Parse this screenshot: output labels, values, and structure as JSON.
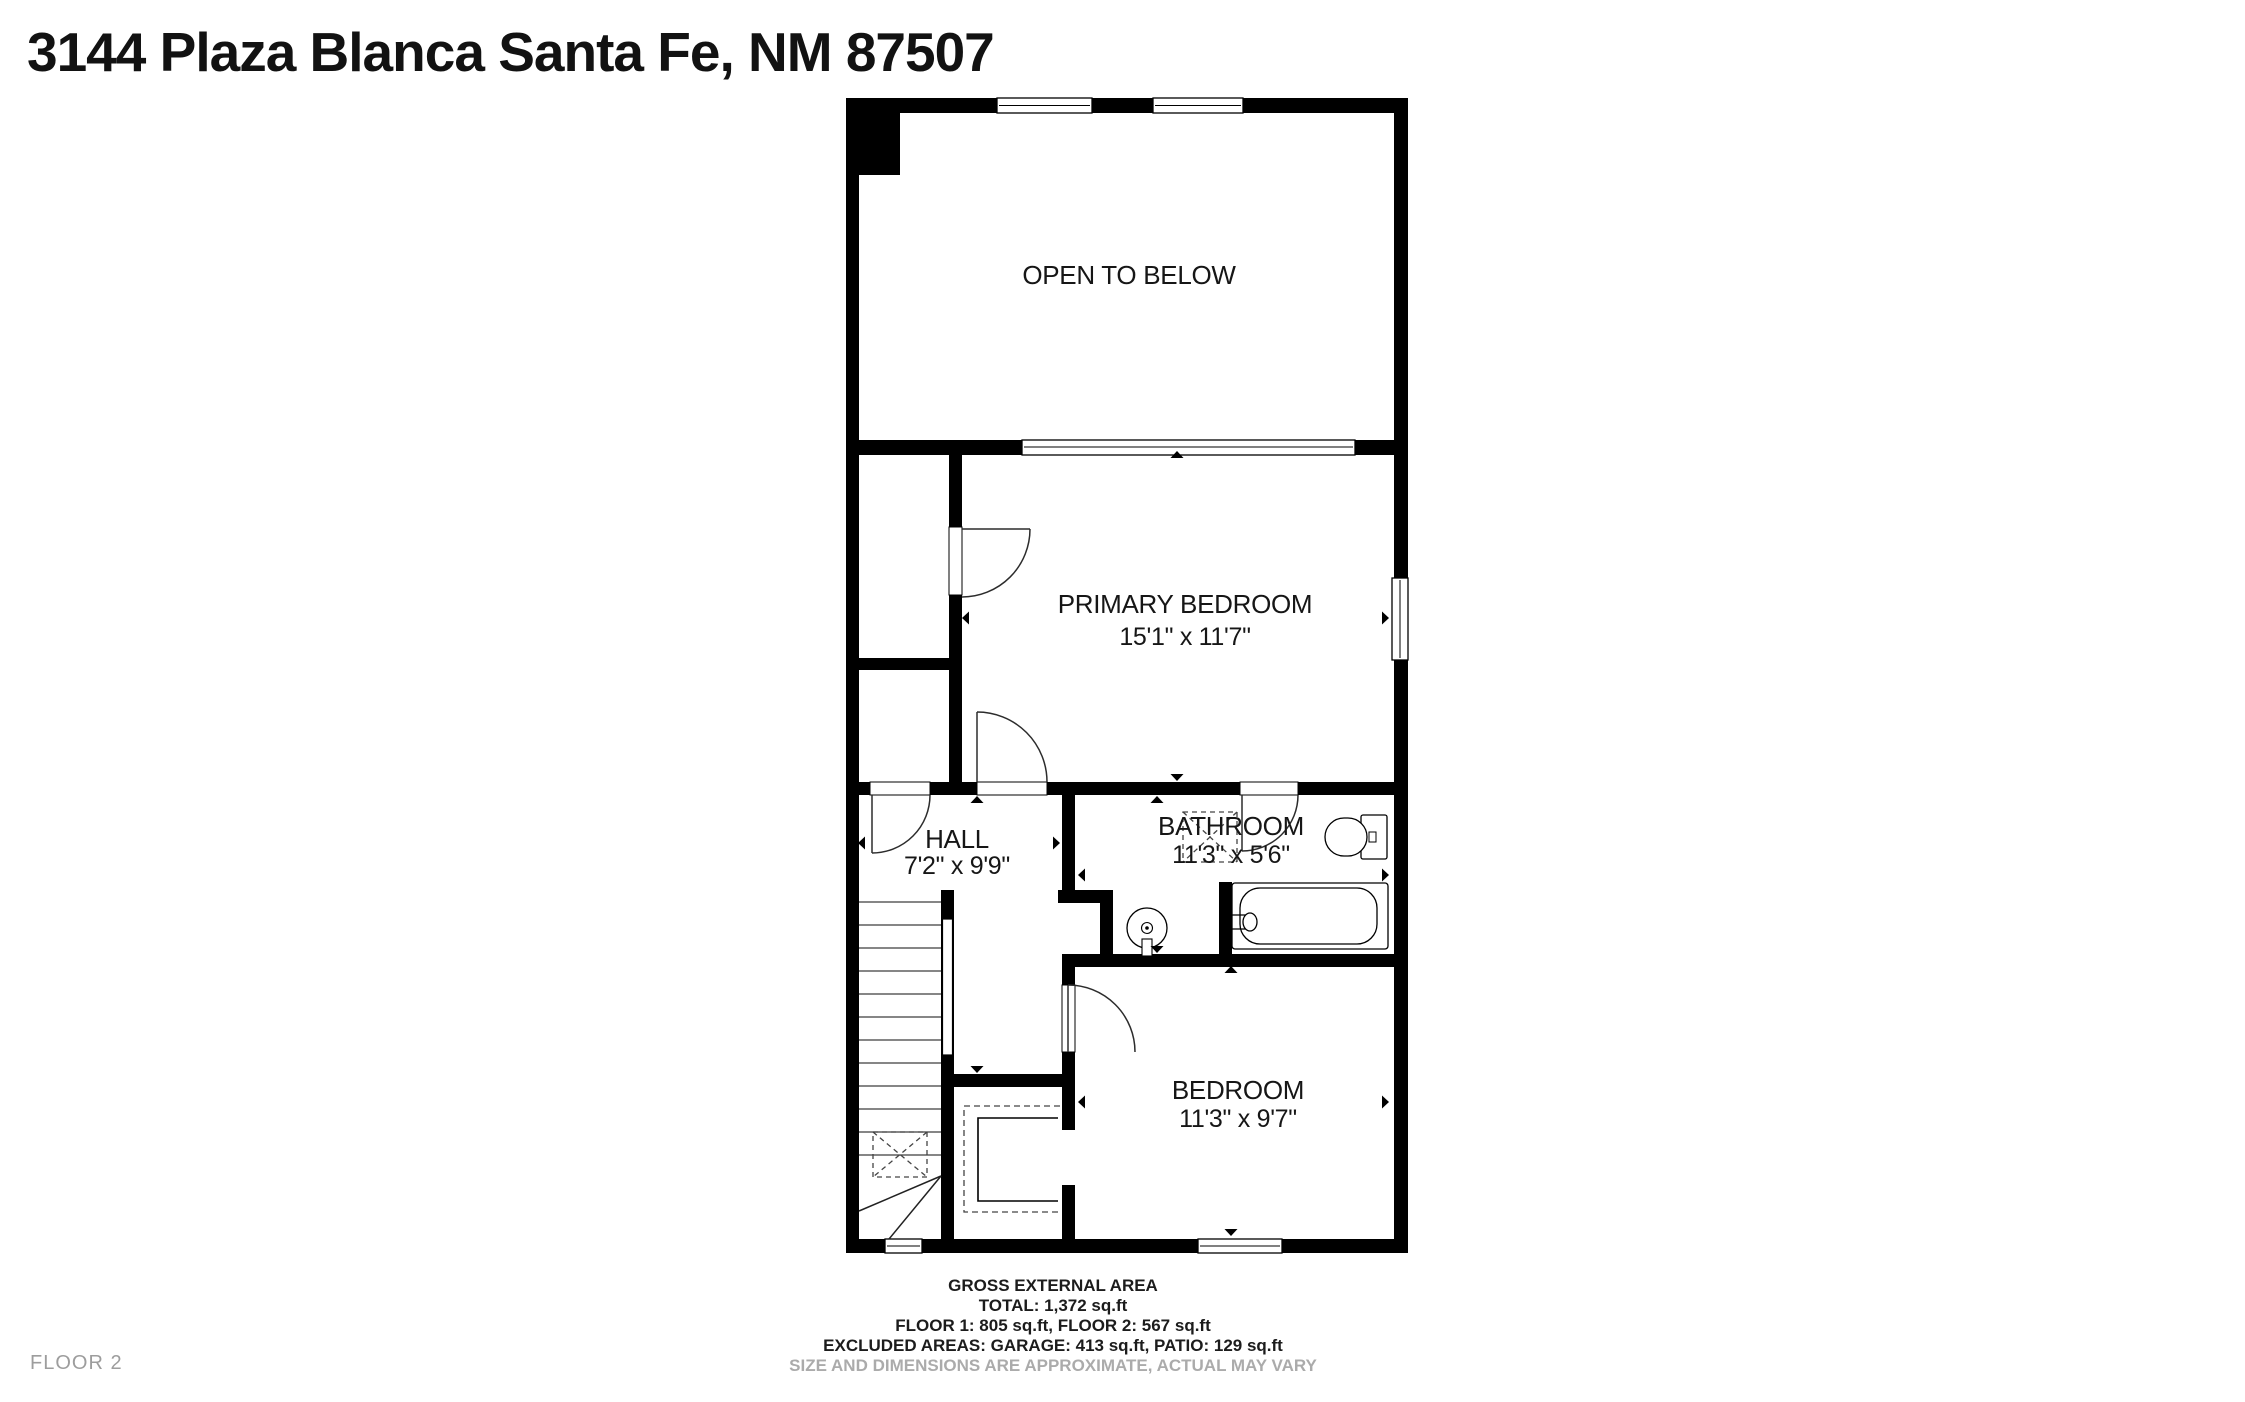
{
  "title": "3144 Plaza Blanca Santa Fe, NM 87507",
  "floor_label": "FLOOR 2",
  "rooms": {
    "open_to_below": {
      "name": "OPEN TO BELOW"
    },
    "primary_bedroom": {
      "name": "PRIMARY BEDROOM",
      "dimensions": "15'1\" x 11'7\""
    },
    "hall": {
      "name": "HALL",
      "dimensions": "7'2\" x 9'9\""
    },
    "bathroom": {
      "name": "BATHROOM",
      "dimensions": "11'3\" x 5'6\""
    },
    "bedroom": {
      "name": "BEDROOM",
      "dimensions": "11'3\" x 9'7\""
    }
  },
  "footer": {
    "heading": "GROSS EXTERNAL AREA",
    "total": "TOTAL: 1,372 sq.ft",
    "floors": "FLOOR 1: 805 sq.ft, FLOOR 2: 567 sq.ft",
    "excluded": "EXCLUDED AREAS: GARAGE: 413 sq.ft, PATIO: 129 sq.ft",
    "disclaimer": "SIZE AND DIMENSIONS ARE APPROXIMATE, ACTUAL MAY VARY"
  },
  "colors": {
    "wall": "#000000",
    "background": "#ffffff",
    "muted_text": "#ababab"
  }
}
